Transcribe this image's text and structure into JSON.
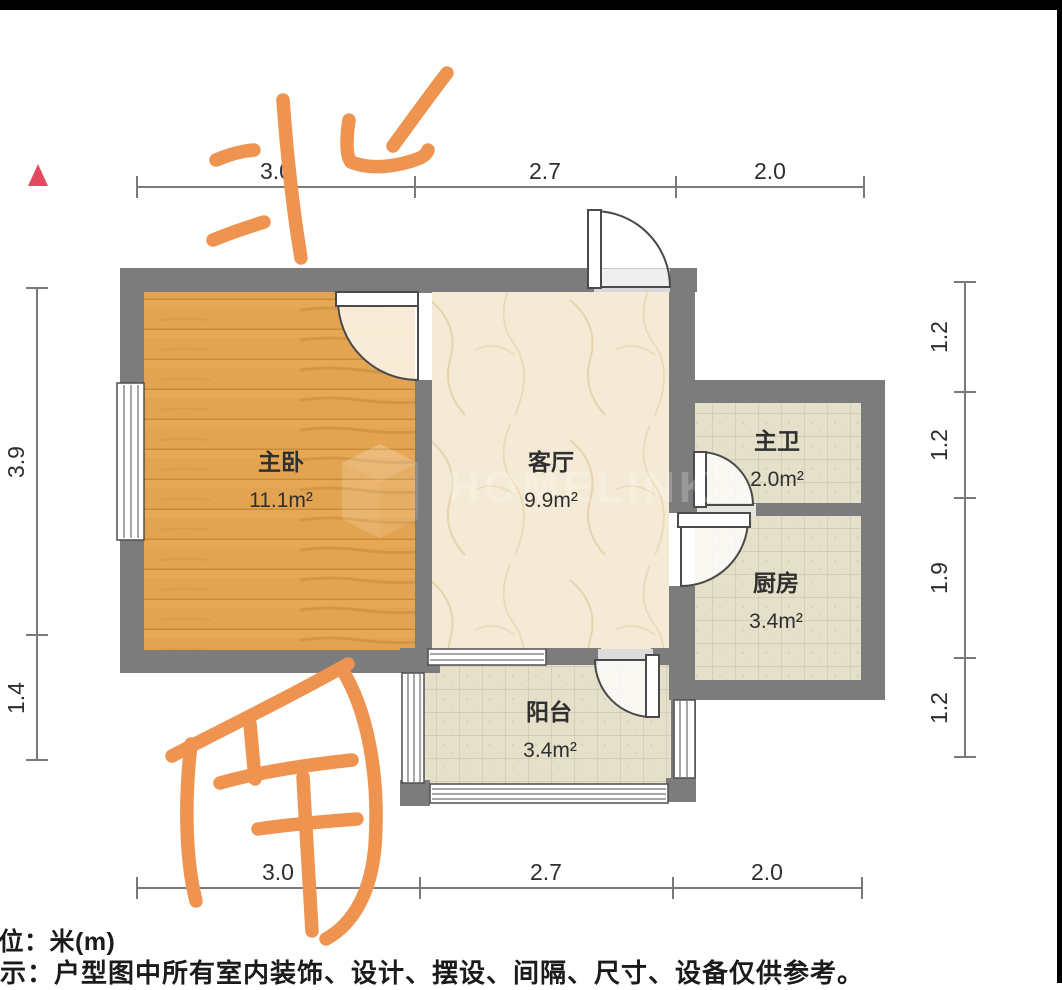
{
  "compass": {
    "north": "北",
    "south": "南"
  },
  "rooms": {
    "bedroom": {
      "name": "主卧",
      "area": "11.1m²"
    },
    "living": {
      "name": "客厅",
      "area": "9.9m²"
    },
    "bathroom": {
      "name": "主卫",
      "area": "2.0m²"
    },
    "kitchen": {
      "name": "厨房",
      "area": "3.4m²"
    },
    "balcony": {
      "name": "阳台",
      "area": "3.4m²"
    }
  },
  "dimensions": {
    "top": [
      "3.0",
      "2.7",
      "2.0"
    ],
    "bottom": [
      "3.0",
      "2.7",
      "2.0"
    ],
    "left": [
      "3.9",
      "1.4"
    ],
    "right": [
      "1.2",
      "1.2",
      "1.9",
      "1.2"
    ]
  },
  "watermark": {
    "text": "HOMELINK"
  },
  "footer": {
    "unit_line": "单位：米(m)",
    "disclaimer_line": "提示：户型图中所有室内装饰、设计、摆设、间隔、尺寸、设备仅供参考。"
  },
  "colors": {
    "wall": "#7C7C7C",
    "wood_floor": "#E3A452",
    "marble_floor": "#F4EAD5",
    "tile_floor": "#E4E0C9",
    "annotation_orange": "#EF9350",
    "dimension_gray": "#7A7A7A",
    "marker_red": "#E44A5F"
  }
}
